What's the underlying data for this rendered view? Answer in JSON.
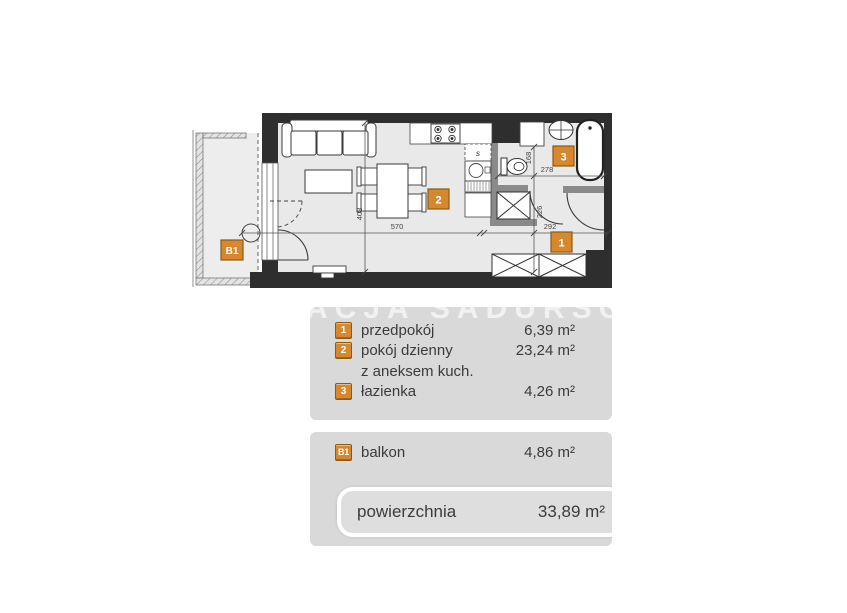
{
  "watermark": "ACJA SADURSCY",
  "plan": {
    "badges": {
      "hall": "1",
      "living": "2",
      "bath": "3",
      "balcony": "B1"
    },
    "dims": {
      "d570": "570",
      "d408": "408",
      "d292": "292",
      "d226": "226",
      "d278": "278",
      "d168": "168"
    },
    "kitchen_symbol": "s"
  },
  "legend": {
    "rooms": [
      {
        "badge": "1",
        "name": "przedpokój",
        "area": "6,39 m²"
      },
      {
        "badge": "2",
        "name": "pokój dzienny",
        "area": "23,24 m²"
      },
      {
        "badge": "",
        "name": "z aneksem kuch.",
        "area": ""
      },
      {
        "badge": "3",
        "name": "łazienka",
        "area": "4,26 m²"
      }
    ],
    "balcony": {
      "badge": "B1",
      "name": "balkon",
      "area": "4,86 m²"
    },
    "total": {
      "label": "powierzchnia",
      "area": "33,89 m²"
    }
  },
  "colors": {
    "accent": "#d5882d",
    "accent_border": "#8c5a17",
    "panel": "#d9d9d9",
    "wall": "#2e2e2e",
    "floor": "#e9e9e9"
  }
}
